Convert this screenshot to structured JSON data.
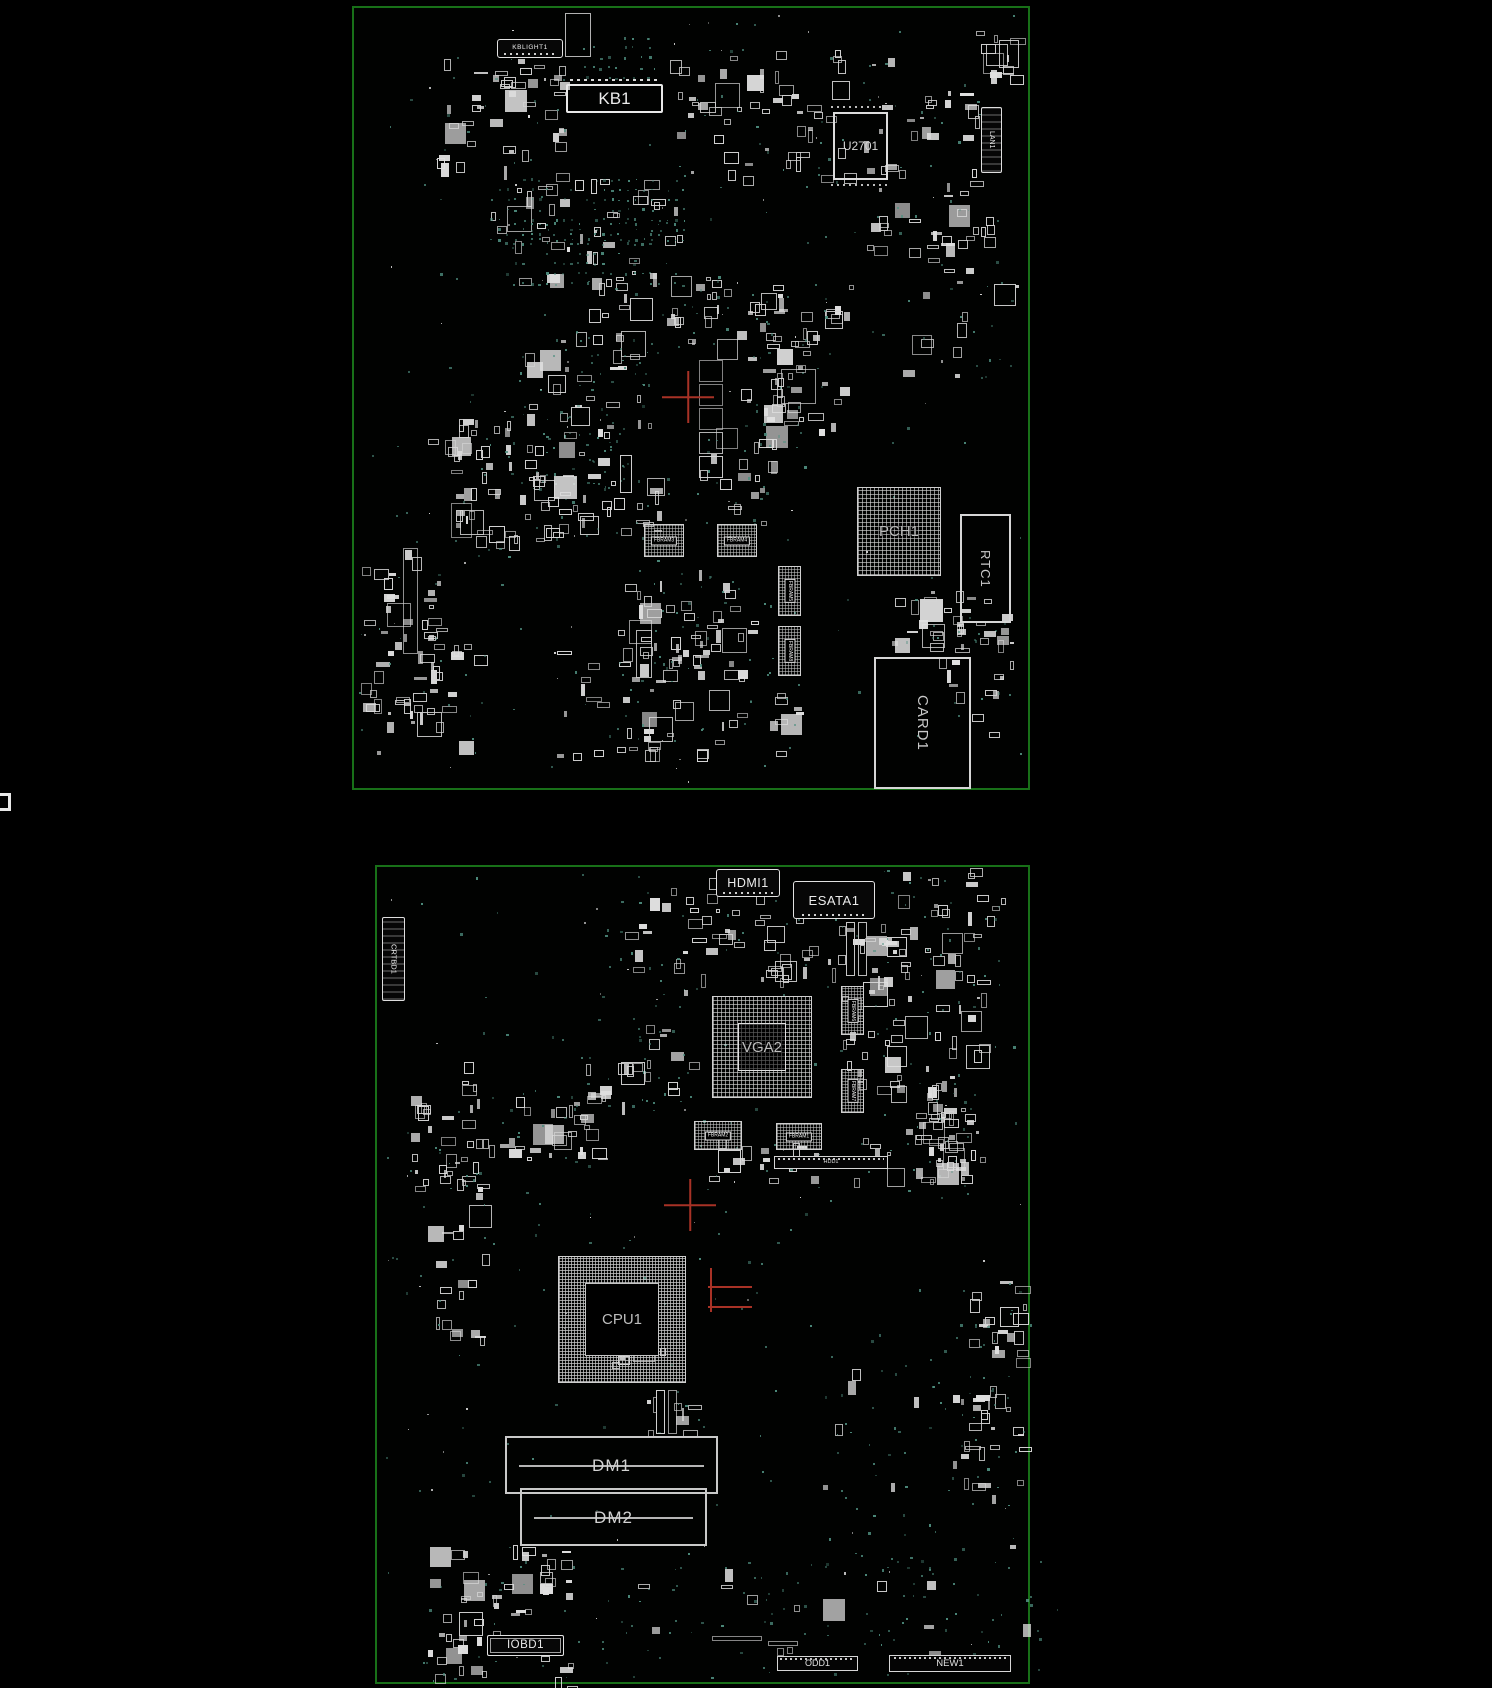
{
  "palette": {
    "background": "#000000",
    "board_outline": "#187018",
    "component": "#e0e0e0",
    "chip_text": "#bdbdbd",
    "via": "#4f8f80",
    "highlight": "#a83226"
  },
  "boards": [
    {
      "name": "top-side-board",
      "x": 352,
      "y": 6,
      "w": 678,
      "h": 784
    },
    {
      "name": "bottom-side-board",
      "x": 375,
      "y": 865,
      "w": 655,
      "h": 819
    }
  ],
  "components": [
    {
      "name": "kblight1-connector",
      "label": "KBLIGHT1",
      "kind": "labelbox",
      "x": 497,
      "y": 39,
      "w": 66,
      "h": 19,
      "fs": 6.5
    },
    {
      "name": "kb1-connector",
      "label": "KB1",
      "kind": "slotbox",
      "x": 566,
      "y": 84,
      "w": 97,
      "h": 29,
      "fs": 17
    },
    {
      "name": "u2701-chip",
      "label": "U2701",
      "kind": "chipbox",
      "x": 833,
      "y": 112,
      "w": 55,
      "h": 68,
      "fs": 12
    },
    {
      "name": "lan1-connector",
      "label": "LAN1",
      "kind": "vlabelbox",
      "x": 981,
      "y": 107,
      "w": 21,
      "h": 66,
      "fs": 7
    },
    {
      "name": "pch1-bga",
      "label": "PCH1",
      "kind": "bga",
      "x": 857,
      "y": 487,
      "w": 84,
      "h": 89,
      "fs": 15
    },
    {
      "name": "rtc1-module",
      "label": "RTC1",
      "kind": "vchipbox",
      "x": 960,
      "y": 514,
      "w": 51,
      "h": 109,
      "fs": 13
    },
    {
      "name": "card1-slot",
      "label": "CARD1",
      "kind": "vchipbox",
      "x": 874,
      "y": 657,
      "w": 97,
      "h": 132,
      "fs": 15
    },
    {
      "name": "fbram3-chip",
      "label": "FBRAM3",
      "kind": "ramchip",
      "x": 644,
      "y": 524,
      "w": 40,
      "h": 33,
      "fs": 5
    },
    {
      "name": "fbram4-chip",
      "label": "FBRAM4",
      "kind": "ramchip",
      "x": 717,
      "y": 524,
      "w": 40,
      "h": 33,
      "fs": 5
    },
    {
      "name": "fbram5-chip",
      "label": "FBRAM5",
      "kind": "vramchip",
      "x": 778,
      "y": 566,
      "w": 23,
      "h": 50,
      "fs": 5
    },
    {
      "name": "fbram8-chip",
      "label": "FBRAM8",
      "kind": "vramchip",
      "x": 778,
      "y": 626,
      "w": 23,
      "h": 50,
      "fs": 5
    },
    {
      "name": "hdmi1-connector",
      "label": "HDMI1",
      "kind": "labelbox",
      "x": 716,
      "y": 869,
      "w": 64,
      "h": 28,
      "fs": 12.5
    },
    {
      "name": "esata1-connector",
      "label": "ESATA1",
      "kind": "labelbox",
      "x": 793,
      "y": 881,
      "w": 82,
      "h": 38,
      "fs": 13
    },
    {
      "name": "crtbd1-connector",
      "label": "CRTBD1",
      "kind": "vlabelbox",
      "x": 382,
      "y": 917,
      "w": 23,
      "h": 84,
      "fs": 7.5
    },
    {
      "name": "vga2-bga",
      "label": "VGA2",
      "kind": "bga2",
      "x": 712,
      "y": 996,
      "w": 100,
      "h": 102,
      "fs": 15
    },
    {
      "name": "fbram6-chip",
      "label": "FBRAM6",
      "kind": "vramchip",
      "x": 841,
      "y": 986,
      "w": 23,
      "h": 49,
      "fs": 5
    },
    {
      "name": "fbram7-chip",
      "label": "FBRAM7",
      "kind": "vramchip",
      "x": 841,
      "y": 1069,
      "w": 23,
      "h": 44,
      "fs": 5
    },
    {
      "name": "fbram2-chip",
      "label": "FBRAM2",
      "kind": "ramchip",
      "x": 694,
      "y": 1121,
      "w": 48,
      "h": 29,
      "fs": 5
    },
    {
      "name": "fbram1-chip",
      "label": "FBRAM1",
      "kind": "ramchip",
      "x": 776,
      "y": 1123,
      "w": 46,
      "h": 27,
      "fs": 5
    },
    {
      "name": "hdd1-connector",
      "label": "HDD1",
      "kind": "pinstrip",
      "x": 774,
      "y": 1156,
      "w": 114,
      "h": 13,
      "fs": 5.5
    },
    {
      "name": "cpu1-bga",
      "label": "CPU1",
      "kind": "cpu",
      "x": 558,
      "y": 1256,
      "w": 128,
      "h": 127,
      "fs": 15
    },
    {
      "name": "dm1-slot",
      "label": "DM1",
      "kind": "dimmslot",
      "x": 505,
      "y": 1436,
      "w": 213,
      "h": 58,
      "fs": 17
    },
    {
      "name": "dm2-slot",
      "label": "DM2",
      "kind": "dimmslot",
      "x": 520,
      "y": 1488,
      "w": 187,
      "h": 58,
      "fs": 17
    },
    {
      "name": "iobd1-connector",
      "label": "IOBD1",
      "kind": "labelbox2",
      "x": 487,
      "y": 1635,
      "w": 77,
      "h": 21,
      "fs": 11.5
    },
    {
      "name": "odd1-connector",
      "label": "ODD1",
      "kind": "pinstrip",
      "x": 777,
      "y": 1656,
      "w": 81,
      "h": 15,
      "fs": 9
    },
    {
      "name": "new1-connector",
      "label": "NEW1",
      "kind": "pinstrip",
      "x": 889,
      "y": 1655,
      "w": 122,
      "h": 17,
      "fs": 9.5
    }
  ],
  "highlights": [
    {
      "name": "crosshair-top",
      "type": "cross",
      "x": 688,
      "y": 397,
      "r": 26
    },
    {
      "name": "crosshair-bottom",
      "type": "cross",
      "x": 690,
      "y": 1205,
      "r": 26
    },
    {
      "name": "cursor-line-v",
      "type": "line",
      "x": 710,
      "y": 1268,
      "w": 1.5,
      "h": 44
    },
    {
      "name": "cursor-line-h1",
      "type": "line",
      "x": 708,
      "y": 1286,
      "w": 44,
      "h": 1.5
    },
    {
      "name": "cursor-line-h2",
      "type": "line",
      "x": 708,
      "y": 1306,
      "w": 44,
      "h": 1.5
    }
  ]
}
